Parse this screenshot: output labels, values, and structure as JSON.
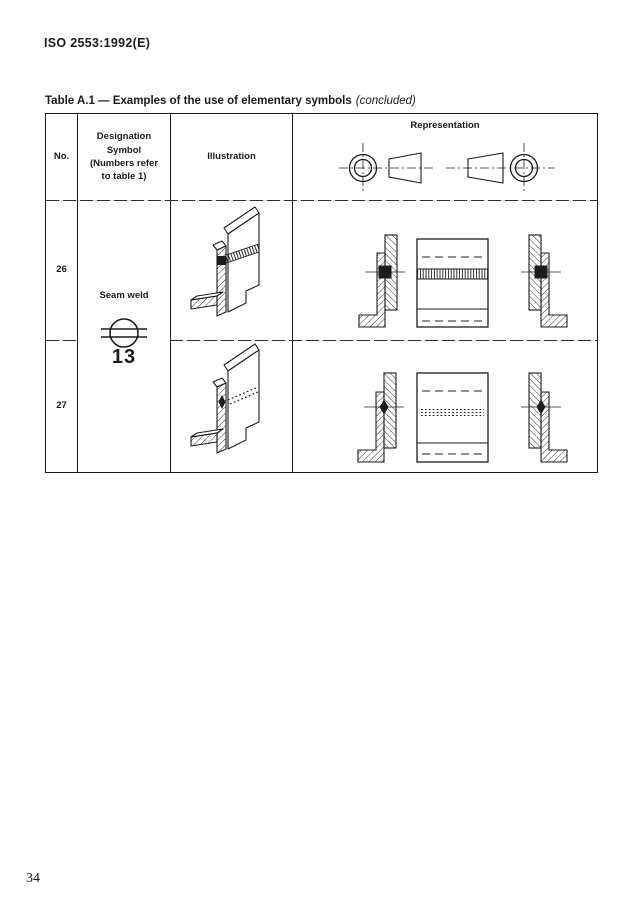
{
  "page": {
    "standard_ref": "ISO 2553:1992(E)",
    "page_number": "34"
  },
  "table": {
    "title": {
      "main": "Table A.1 — Examples of the use of elementary symbols",
      "suffix": "(concluded)"
    },
    "header": {
      "no": "No.",
      "designation_lines": [
        "Designation",
        "Symbol",
        "(Numbers refer",
        "to table 1)"
      ],
      "illustration": "Illustration",
      "representation": "Representation",
      "projection_symbols": [
        "first-angle-projection-symbol",
        "third-angle-projection-symbol"
      ]
    },
    "designation": {
      "label": "Seam weld",
      "symbol_icon": "seam-weld-symbol",
      "symbol_number": "13"
    },
    "rows": [
      {
        "no": "26",
        "weld_marker": "filled-square",
        "seam_style": "visible-seam-coil",
        "views": [
          "left-section-view",
          "front-view",
          "right-section-view"
        ]
      },
      {
        "no": "27",
        "weld_marker": "filled-diamond",
        "seam_style": "hidden-seam-dotted",
        "views": [
          "left-section-view",
          "front-view",
          "right-section-view"
        ]
      }
    ]
  },
  "colors": {
    "ink": "#1c1c1c",
    "paper": "#ffffff"
  }
}
